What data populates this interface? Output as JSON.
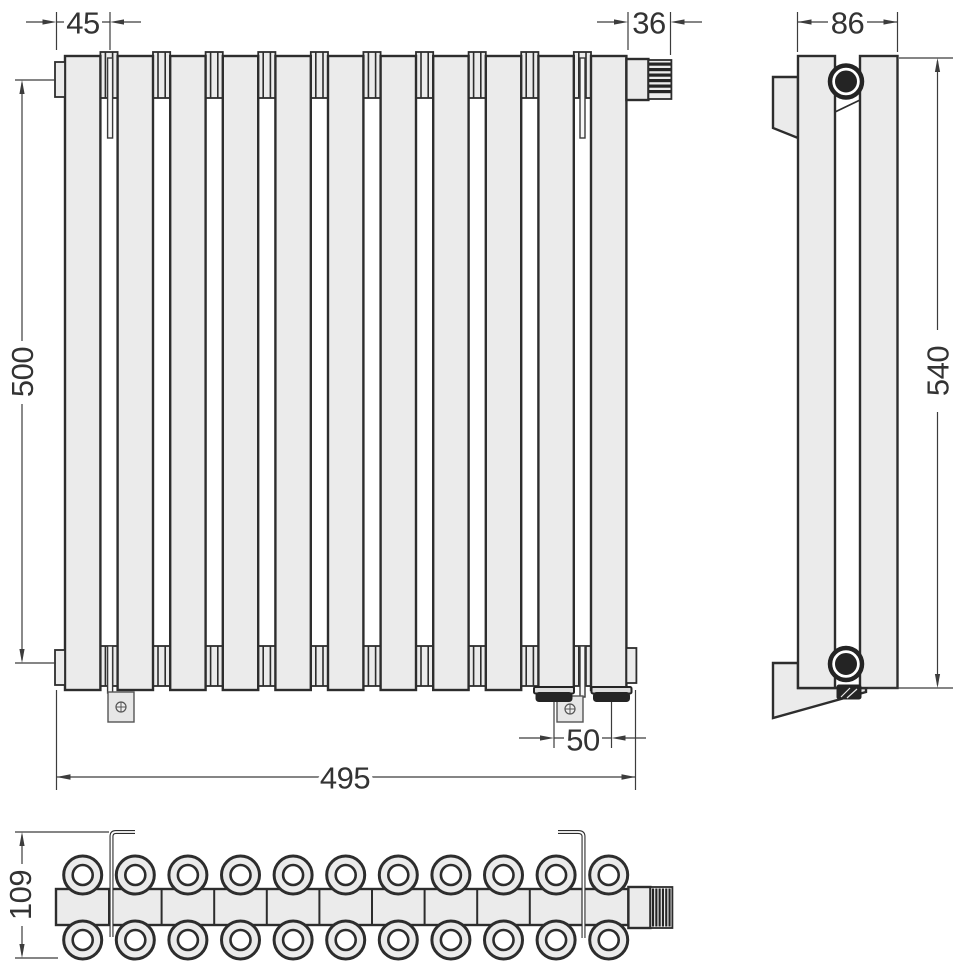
{
  "drawing": {
    "kind": "radiator-technical-drawing",
    "section_count": 11,
    "views": {
      "front_view": {
        "dimensions": {
          "bracket_offset_top": "45",
          "valve_length_top": "36",
          "axis_distance_left": "500",
          "connection_spacing_bottom": "50",
          "overall_width_bottom": "495"
        }
      },
      "side_view": {
        "dimensions": {
          "depth_top": "86",
          "overall_height_right": "540"
        }
      },
      "top_view": {
        "dimensions": {
          "depth_with_bracket_left": "109"
        }
      }
    },
    "colors": {
      "background": "#ffffff",
      "body_fill": "#ebebeb",
      "outline": "#2d2d2d",
      "dimension_line": "#3c3c3c",
      "dimension_text": "#333333",
      "dark_detail": "#242424"
    }
  }
}
